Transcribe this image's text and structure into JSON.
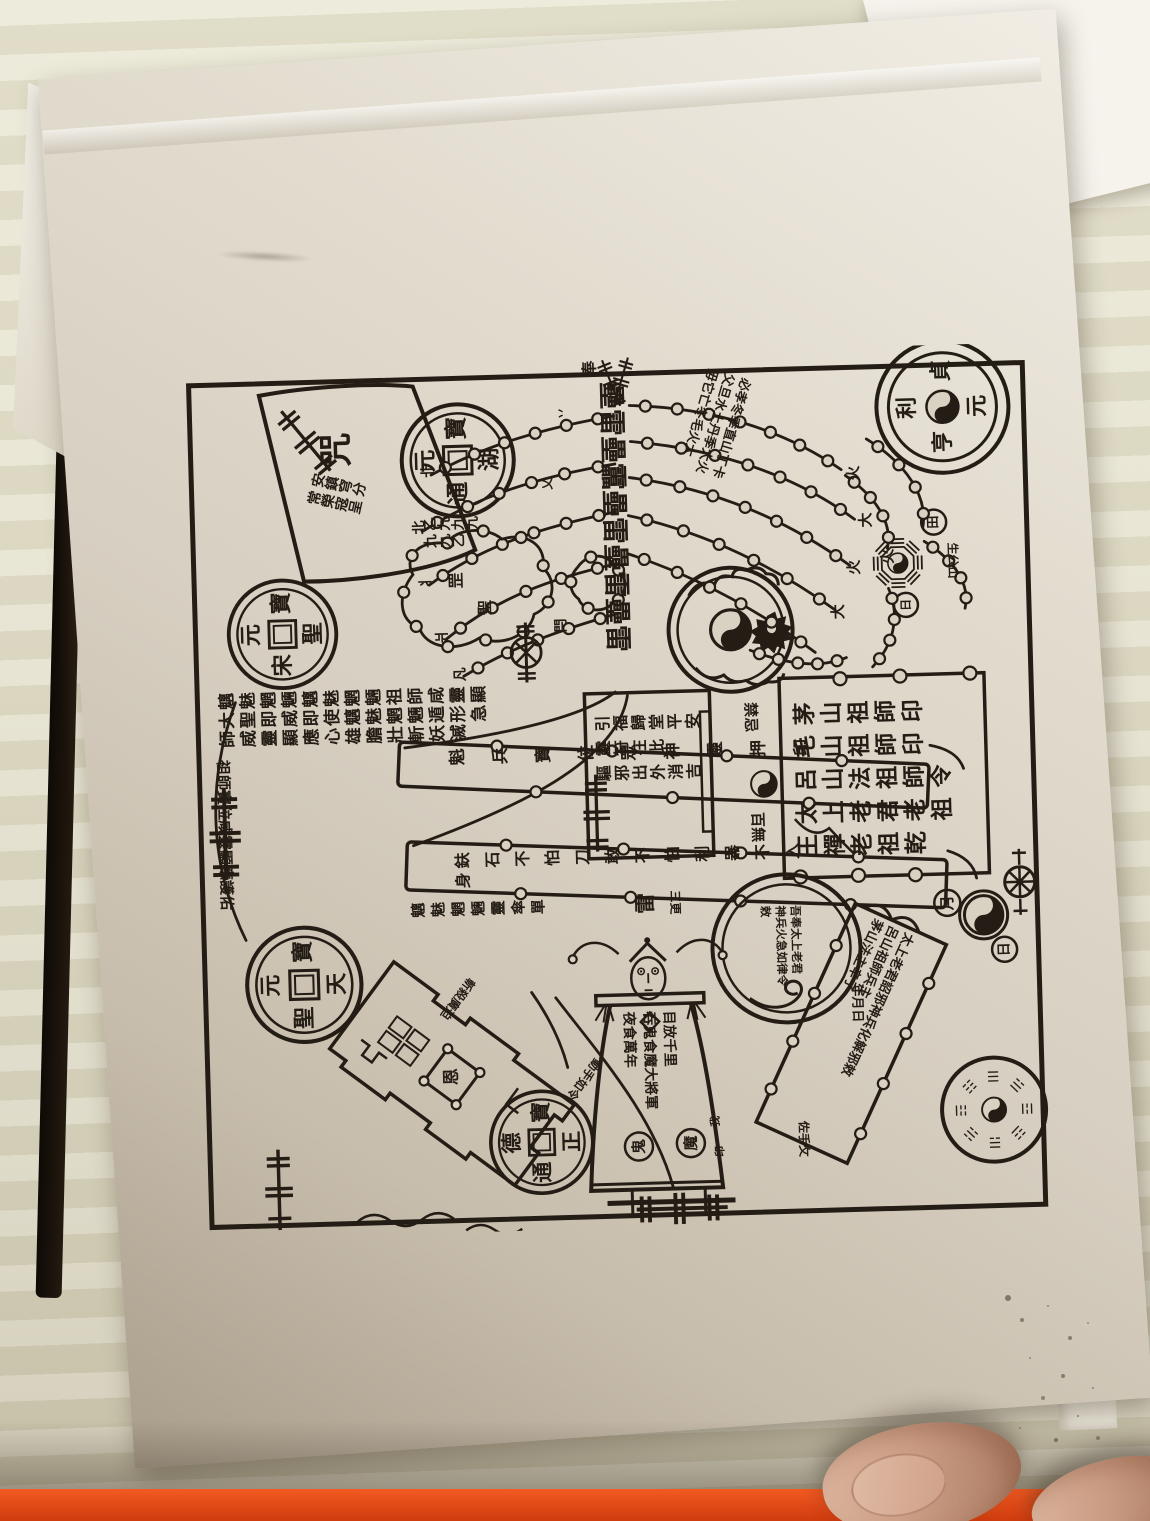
{
  "plate": {
    "corner_circle": {
      "top": "貞",
      "right": "元",
      "bottom": "亨",
      "left": "利"
    },
    "coins": [
      {
        "top": "寶",
        "right": "湖",
        "bottom": "通",
        "left": "元"
      },
      {
        "top": "寶",
        "right": "聖",
        "bottom": "宋",
        "left": "元"
      },
      {
        "top": "寶",
        "right": "天",
        "bottom": "聖",
        "left": "元"
      },
      {
        "top": "寶",
        "right": "正",
        "bottom": "通",
        "left": "德"
      }
    ],
    "right_panel": {
      "lines": "茅山祖師印\n毛山祖師印\n呂山法祖師令\n太上老君老祖\n王禪老祖乾"
    },
    "center_panel": {
      "lines": "引福歸堂平安\n靈符在此\n驅邪出外消吉"
    },
    "taboo": {
      "top": "禁忌",
      "bottom": "百無"
    },
    "script_block": {
      "lines": "魑魅魍魎魑魅魍魎祖師咸靈顯\n大聖即威即使魑魅魍魎遁形急\n師威靈顯應心雄膽壯斬妖滅"
    },
    "margin_col": {
      "text": "祖師寶位咸靈顯應護佑"
    },
    "bands": {
      "top": "魁兵寶位眾神靈押印",
      "bottom": "鈇石不怕刀敢不怕利器不入身",
      "below": "魑魅魍魎靈傘單"
    },
    "tree": {
      "trunk": "壘雷壘靁壘雷壘雷壘雷",
      "canopy": "奉",
      "side_cols": "必孝冬季直山丁卡\n父旦水土丹季大火\n毋它亡冬毛火大",
      "left_tips": [
        "卝",
        "北",
        "丬",
        "爿",
        "凡"
      ],
      "fire": [
        "火",
        "大",
        "火",
        "大",
        "火"
      ],
      "gate": "閂",
      "sprout_a": "丷",
      "sprout_b": "乂"
    },
    "cloud": {
      "a": "罡",
      "b": "聖"
    },
    "nines": {
      "lines": "乙九九九\n九九乙"
    },
    "tl_banner": {
      "big": "咒",
      "small": "安鎮穹分\n常榮寇呈"
    },
    "figure": {
      "lines": "目放千里\n吞鬼食魔大將軍\n夜食萬年",
      "seal_right": "魔",
      "seal_left": "鬼",
      "head": "雷",
      "mark_a": "我",
      "mark_b": "印"
    },
    "spell": {
      "lines": "吾奉太上老君\n神兵火急如律令\n敕"
    },
    "banner": {
      "lines": "太上老君詔邪神兵化解邪敕\n呂山祖師兵主\n茅山法主辛子",
      "date": "年月日",
      "hand": "佐手攵"
    },
    "fortress": {
      "seal": "恩",
      "note_a": "斬殺廣迫",
      "note_b": "動手如令"
    },
    "circled": {
      "moon": "月",
      "sun": "日",
      "field": "田",
      "day": "日"
    },
    "trigrams": [
      "☰",
      "☱",
      "☲",
      "☳",
      "☴",
      "☵",
      "☶",
      "☷"
    ],
    "extra": {
      "geng": "三更",
      "side": "生公山"
    }
  }
}
